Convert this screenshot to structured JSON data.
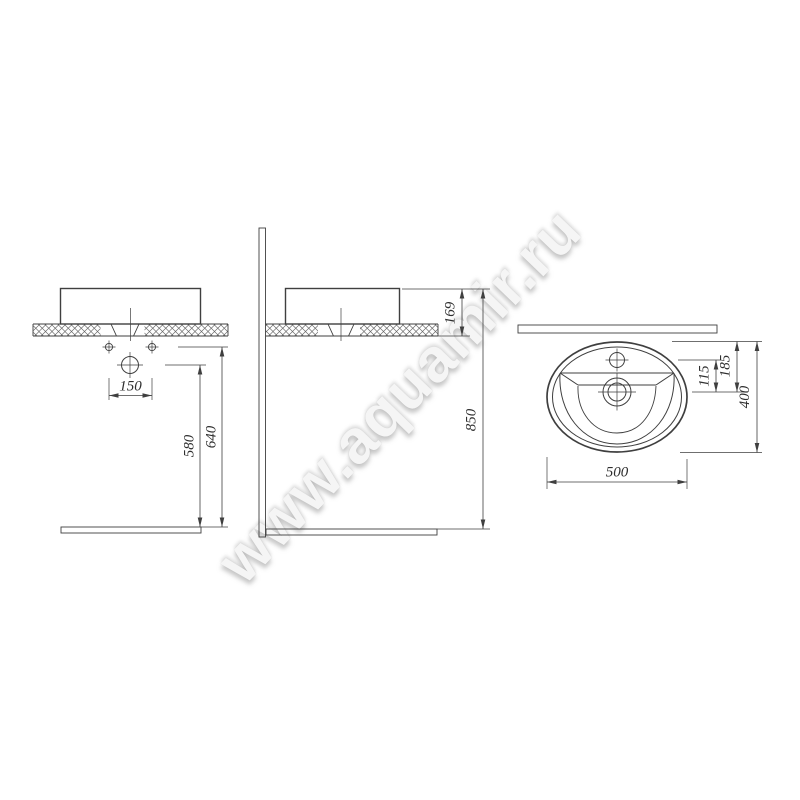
{
  "watermark": {
    "text": "www.aquamir.ru"
  },
  "views": {
    "front": {
      "label": "front-view",
      "dims": {
        "hole_spacing": "150",
        "drain_to_floor": "580",
        "holes_to_floor": "640"
      }
    },
    "side": {
      "label": "side-view",
      "dims": {
        "rim_above_counter": "169",
        "rim_to_floor": "850"
      }
    },
    "top": {
      "label": "top-view",
      "dims": {
        "faucet_to_drain": "115",
        "back_to_drain": "185",
        "depth": "400",
        "width": "500"
      }
    }
  },
  "colors": {
    "line": "#3f3f3f",
    "dim_text": "#2f2f2f",
    "hatch": "#666666",
    "stipple": "#8a8a8a",
    "watermark": "#f5f5f5"
  }
}
